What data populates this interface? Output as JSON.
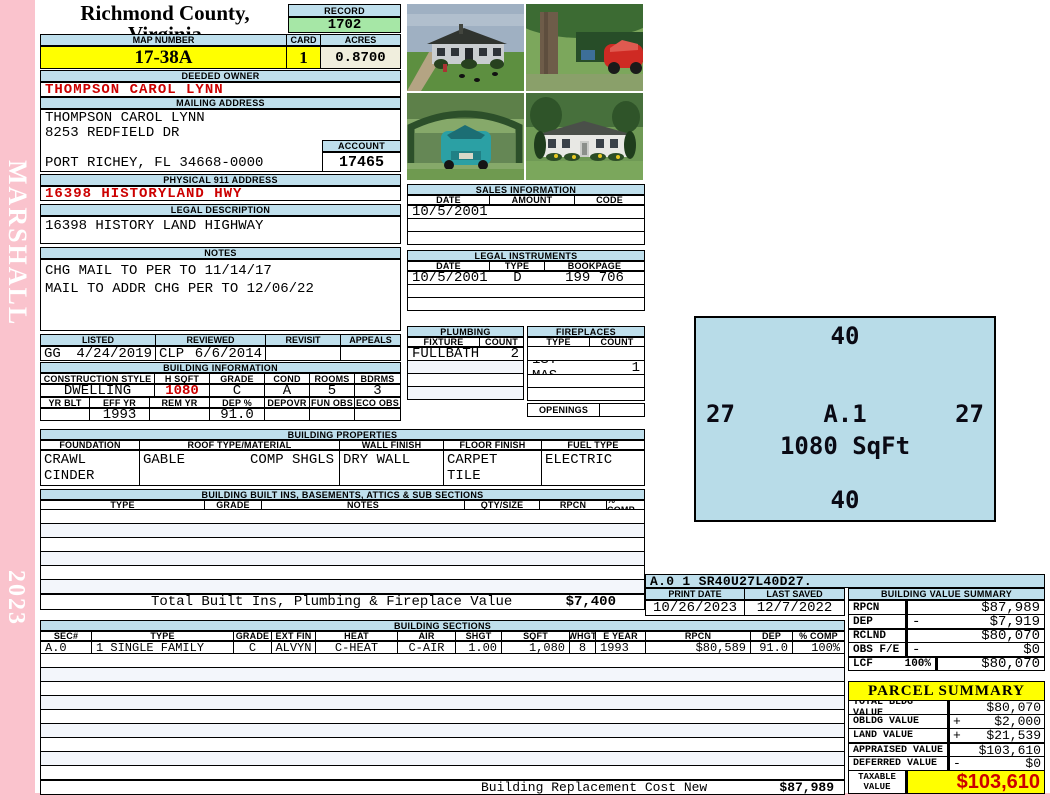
{
  "colors": {
    "sidebar_pink": "#fac3cd",
    "header_blue": "#bfdfec",
    "record_green": "#a6e7a6",
    "highlight_yellow": "#ffff00",
    "acres_cream": "#f0eedd",
    "alert_red": "#cc0000",
    "sketch_blue": "#b8dce8"
  },
  "sidebar": {
    "vendor": "MARSHALL",
    "year": "2023"
  },
  "header": {
    "county": "Richmond County, Virginia",
    "subtitle": "Commissioner of the Revenue, PO Box 366, Warsaw, VA 22572",
    "record_label": "RECORD",
    "record_value": "1702",
    "map_number_label": "MAP NUMBER",
    "map_number": "17-38A",
    "card_label": "CARD",
    "card": "1",
    "acres_label": "ACRES",
    "acres": "0.8700"
  },
  "owner": {
    "deeded_owner_label": "DEEDED OWNER",
    "deeded_owner": "THOMPSON CAROL LYNN",
    "mailing_address_label": "MAILING ADDRESS",
    "mailing_lines": [
      "THOMPSON CAROL LYNN",
      "8253 REDFIELD DR",
      "",
      "PORT RICHEY, FL 34668-0000"
    ],
    "account_label": "ACCOUNT",
    "account": "17465",
    "physical_address_label": "PHYSICAL 911 ADDRESS",
    "physical_address": "16398 HISTORYLAND HWY",
    "legal_description_label": "LEGAL DESCRIPTION",
    "legal_description": "16398 HISTORY LAND HIGHWAY",
    "notes_label": "NOTES",
    "notes": [
      "CHG MAIL TO PER TO 11/14/17",
      "MAIL TO ADDR CHG PER TO 12/06/22"
    ]
  },
  "review": {
    "headers": [
      "LISTED",
      "REVIEWED",
      "REVISIT",
      "APPEALS"
    ],
    "listed_by": "GG",
    "listed_date": "4/24/2019",
    "reviewed_by": "CLP",
    "reviewed_date": "6/6/2014",
    "revisit": "",
    "appeals": ""
  },
  "building_information": {
    "title": "BUILDING INFORMATION",
    "row1_headers": [
      "CONSTRUCTION STYLE",
      "H SQFT",
      "GRADE",
      "COND",
      "ROOMS",
      "BDRMS"
    ],
    "row1_values": [
      "DWELLING",
      "1080",
      "C",
      "A",
      "5",
      "3"
    ],
    "row2_headers": [
      "YR BLT",
      "EFF YR",
      "REM YR",
      "DEP %",
      "DEPOVR",
      "FUN OBS",
      "ECO OBS"
    ],
    "row2_values": [
      "",
      "1993",
      "",
      "91.0",
      "",
      "",
      ""
    ]
  },
  "building_properties": {
    "title": "BUILDING PROPERTIES",
    "headers": [
      "FOUNDATION",
      "ROOF TYPE/MATERIAL",
      "WALL FINISH",
      "FLOOR FINISH",
      "FUEL TYPE"
    ],
    "foundation": [
      "CRAWL",
      "CINDER BLOCK"
    ],
    "roof": [
      "GABLE",
      "COMP SHGLS"
    ],
    "wall": [
      "DRY WALL"
    ],
    "floor": [
      "CARPET",
      "TILE"
    ],
    "fuel": [
      "ELECTRIC"
    ]
  },
  "built_ins": {
    "title": "BUILDING BUILT INS, BASEMENTS, ATTICS & SUB SECTIONS",
    "headers": [
      "TYPE",
      "GRADE",
      "NOTES",
      "QTY/SIZE",
      "RPCN",
      "% COMP"
    ],
    "total_label": "Total Built Ins, Plumbing & Fireplace Value",
    "total_value": "$7,400"
  },
  "sales": {
    "title": "SALES INFORMATION",
    "headers": [
      "DATE",
      "AMOUNT",
      "CODE"
    ],
    "rows": [
      [
        "10/5/2001",
        "",
        ""
      ],
      [
        "",
        "",
        ""
      ],
      [
        "",
        "",
        ""
      ]
    ]
  },
  "legal_instruments": {
    "title": "LEGAL INSTRUMENTS",
    "headers": [
      "DATE",
      "TYPE",
      "BOOKPAGE"
    ],
    "rows": [
      [
        "10/5/2001",
        "D",
        "199 706"
      ],
      [
        "",
        "",
        ""
      ],
      [
        "",
        "",
        ""
      ]
    ]
  },
  "plumbing": {
    "title": "PLUMBING",
    "headers": [
      "FIXTURE",
      "COUNT"
    ],
    "rows": [
      [
        "FULLBATH",
        "2"
      ],
      [
        "",
        ""
      ],
      [
        "",
        ""
      ],
      [
        "",
        ""
      ]
    ]
  },
  "fireplaces": {
    "title": "FIREPLACES",
    "headers": [
      "TYPE",
      "COUNT"
    ],
    "rows": [
      [
        "",
        ""
      ],
      [
        "1ST MAS",
        "1"
      ],
      [
        "",
        ""
      ],
      [
        "",
        ""
      ]
    ],
    "openings_label": "OPENINGS",
    "openings_value": ""
  },
  "photos": [
    "house front view with lawn and driveway",
    "tree, carport shed and red car",
    "teal car under green carport canopy",
    "white house with shrubs and yellow flowers"
  ],
  "sketch": {
    "dim_top": "40",
    "dim_left": "27",
    "dim_right": "27",
    "dim_bottom": "40",
    "label": "A.1",
    "area": "1080 SqFt",
    "code_line": "A.0  1    SR40U27L40D27."
  },
  "print_info": {
    "print_date_label": "PRINT DATE",
    "print_date": "10/26/2023",
    "last_saved_label": "LAST SAVED",
    "last_saved": "12/7/2022"
  },
  "building_value_summary": {
    "title": "BUILDING VALUE SUMMARY",
    "rows": [
      {
        "label": "RPCN",
        "op": "",
        "value": "$87,989"
      },
      {
        "label": "DEP",
        "op": "-",
        "value": "$7,919"
      },
      {
        "label": "RCLND",
        "op": "",
        "value": "$80,070"
      },
      {
        "label": "OBS F/E",
        "op": "-",
        "value": "$0"
      },
      {
        "label": "LCF",
        "pct": "100%",
        "op": "",
        "value": "$80,070"
      }
    ]
  },
  "building_sections": {
    "title": "BUILDING SECTIONS",
    "headers": [
      "SEC#",
      "TYPE",
      "GRADE",
      "EXT FIN",
      "HEAT",
      "AIR",
      "SHGT",
      "SQFT",
      "WHGT",
      "E YEAR",
      "RPCN",
      "DEP",
      "% COMP"
    ],
    "rows": [
      [
        "A.0",
        "1 SINGLE FAMILY",
        "C",
        "ALVYN",
        "C-HEAT",
        "C-AIR",
        "1.00",
        "1,080",
        "8",
        "1993",
        "$80,589",
        "91.0",
        "100%"
      ]
    ],
    "replacement_label": "Building Replacement Cost New",
    "replacement_value": "$87,989"
  },
  "parcel_summary": {
    "title": "PARCEL SUMMARY",
    "rows": [
      {
        "label": "TOTAL BLDG VALUE",
        "op": "",
        "value": "$80,070"
      },
      {
        "label": "OBLDG VALUE",
        "op": "+",
        "value": "$2,000"
      },
      {
        "label": "LAND VALUE",
        "op": "+",
        "value": "$21,539"
      },
      {
        "label": "APPRAISED VALUE",
        "op": "",
        "value": "$103,610"
      },
      {
        "label": "DEFERRED VALUE",
        "op": "-",
        "value": "$0"
      }
    ],
    "taxable_label_line1": "TAXABLE",
    "taxable_label_line2": "VALUE",
    "taxable_value": "$103,610"
  }
}
